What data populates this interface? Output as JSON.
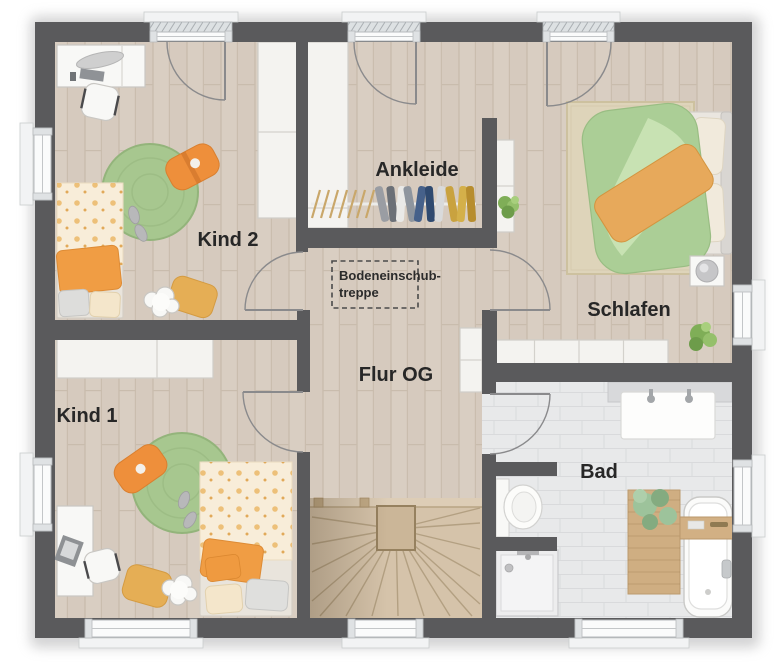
{
  "plan": {
    "rooms": {
      "kind2": "Kind 2",
      "ankleide": "Ankleide",
      "schlafen": "Schlafen",
      "flur": "Flur OG",
      "kind1": "Kind 1",
      "bad": "Bad"
    },
    "annotations": {
      "attic_ladder_line1": "Bodeneinschub-",
      "attic_ladder_line2": "treppe"
    },
    "colors": {
      "wall": "#5a5a5c",
      "wood_floor": "#d9cec2",
      "tile_floor": "#e8e9ea",
      "stair_wood": "#d5c3aa",
      "rug_green": "#a7c78f",
      "accent_orange": "#ee8f3b",
      "duvet_green": "#abce96",
      "furniture_white": "#f4f3f0"
    }
  }
}
